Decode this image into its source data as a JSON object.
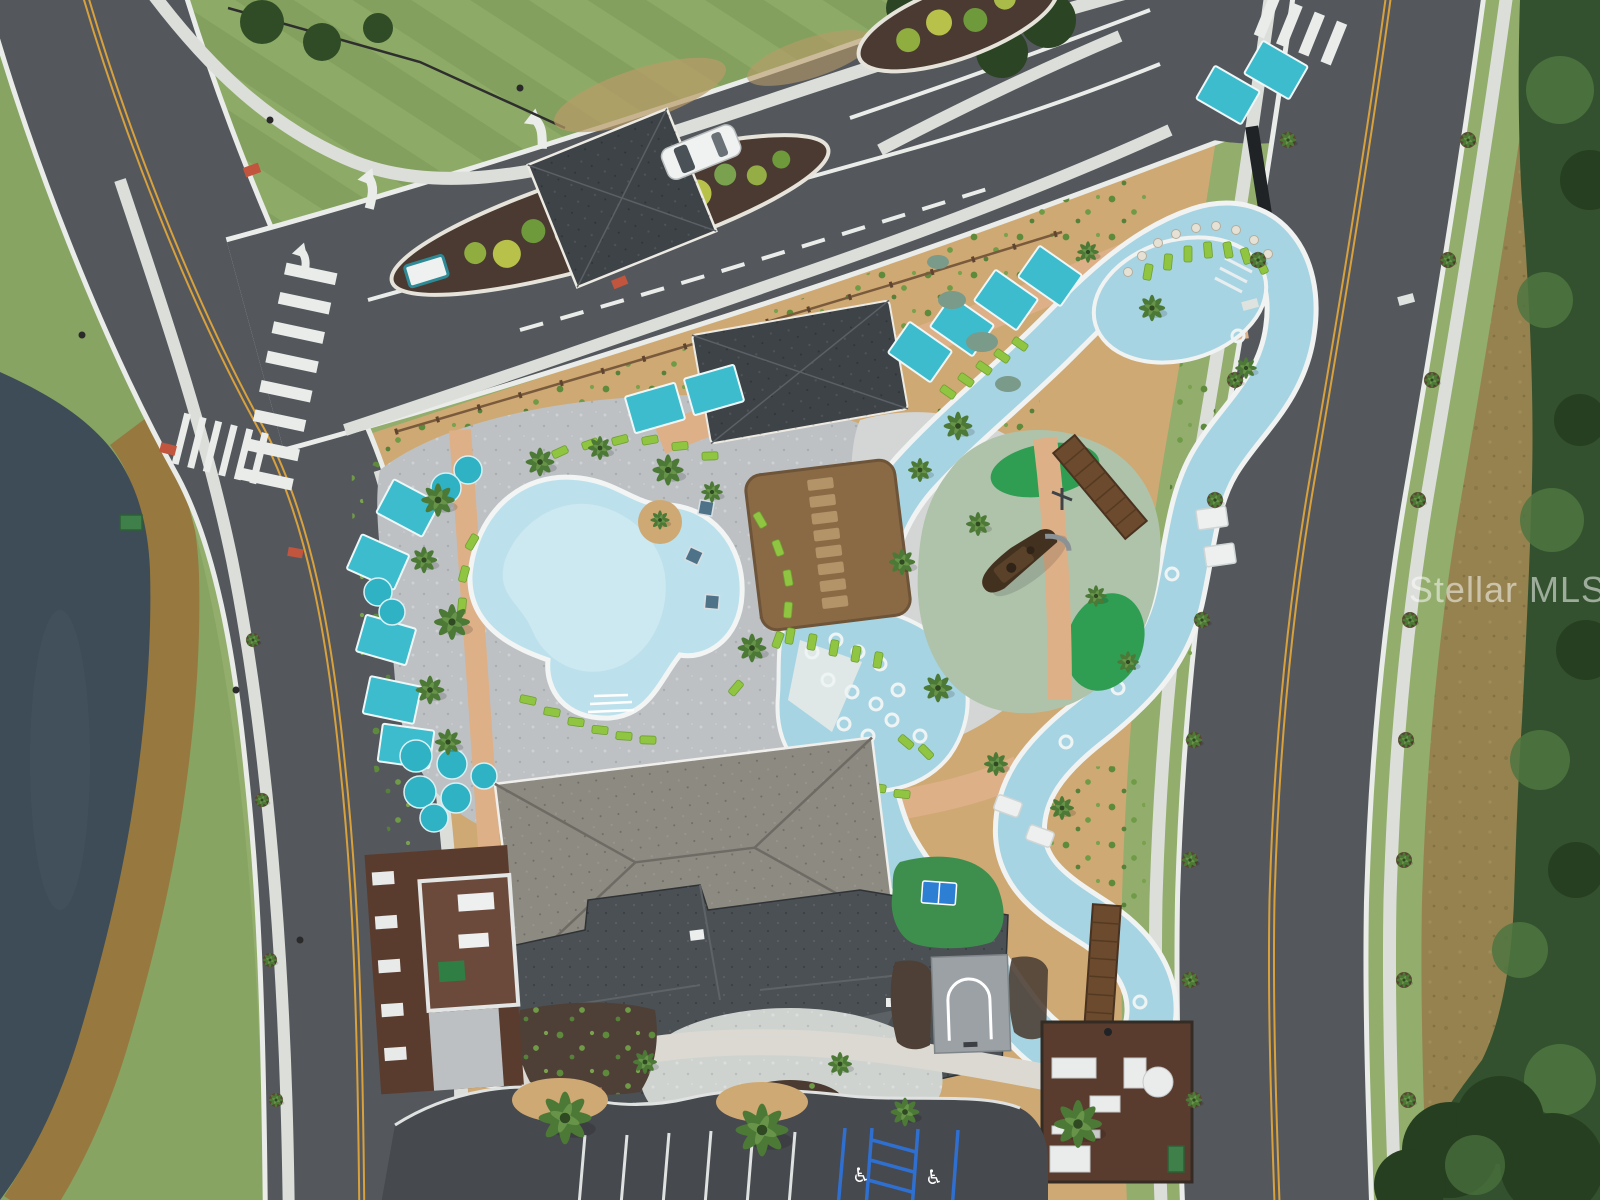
{
  "image": {
    "kind": "aerial-drone-photo",
    "subject": "community amenity center with resort pool, lazy river, playground island, clubhouse, gated entrance, pond and perimeter roads"
  },
  "watermark": {
    "text": "Stellar MLS"
  },
  "palette": {
    "asphalt": "#54585d",
    "asphaltDark": "#46494e",
    "lineWhite": "#e9ece9",
    "lineYellow": "#d8a13c",
    "grass": "#87a463",
    "grassLight": "#92ad6c",
    "grassDark": "#5f7f46",
    "pond": "#3e4c57",
    "brush": "#97793f",
    "field": "#96824f",
    "woods": "#33512e",
    "woodsDark": "#263f20",
    "woodsLight": "#4d7540",
    "sand": "#cfa973",
    "deck": "#bdc1c4",
    "deckLight": "#d3d6d4",
    "pathPeach": "#ddb088",
    "concrete": "#dcdeda",
    "pool": "#bce1ec",
    "river": "#a7d4e2",
    "coping": "#f0f3f2",
    "cabana": "#3cbccc",
    "umbrella": "#2fb2c4",
    "lounger": "#8fc540",
    "roofDark": "#3e4347",
    "roofLight": "#8d8a82",
    "roofClub": "#4b5054",
    "thatch": "#8a6a45",
    "thatchLight": "#b29468",
    "mulch": "#4a3a31",
    "mulchRed": "#5a3c2f",
    "playSurface": "#afc3ab",
    "playGreen": "#2f9e53",
    "ship": "#43311f",
    "bridge": "#6b4a2e",
    "turf": "#3e8f4e",
    "court": "#9ba1a5",
    "parkingBlue": "#2f6fd0",
    "watermark": "#ffffff"
  },
  "scene": {
    "labels": [
      "pond",
      "left-road",
      "entrance-road",
      "right-road",
      "gatehouse",
      "main-pool",
      "lazy-river",
      "splash-pool",
      "playground-island",
      "pirate-ship",
      "tiki-hut",
      "pool-pavilion",
      "clubhouse",
      "parking-lot",
      "basketball-court",
      "turf-lawn",
      "equipment-yards",
      "cabanas",
      "umbrellas",
      "loungers",
      "bridges",
      "crosswalks",
      "watermark"
    ]
  }
}
